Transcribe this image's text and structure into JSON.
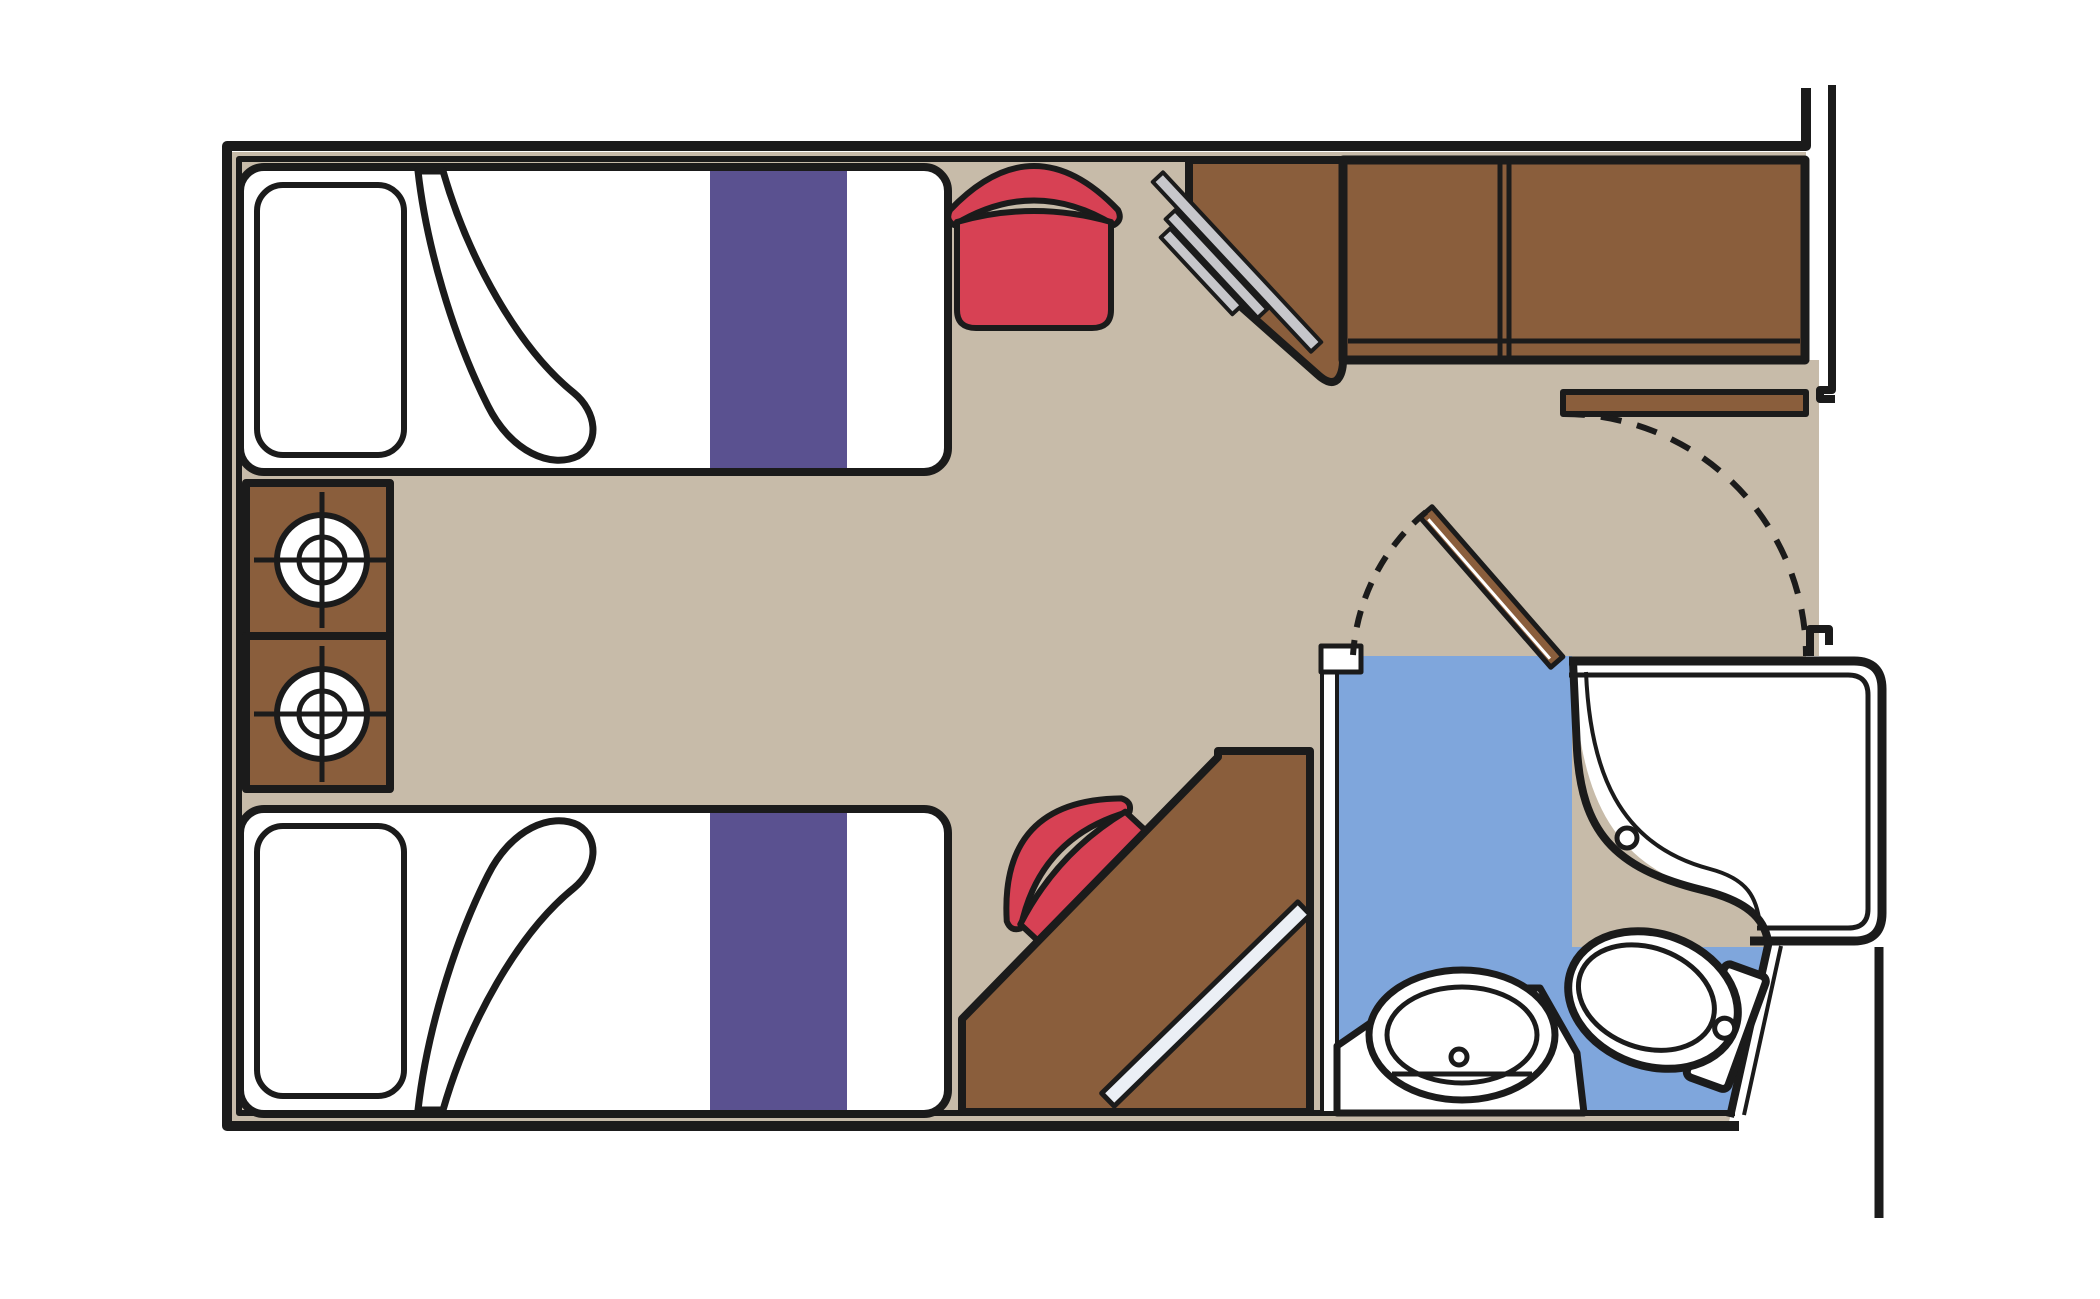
{
  "page": {
    "title": "Cruise cabin floor plan",
    "kind": "floor-plan"
  },
  "colors": {
    "ink": "#1B1B1B",
    "floor": "#C7BBA9",
    "wood": "#8A5E3C",
    "bathroom_floor": "#7FA6DC",
    "bed_runner": "#5A5190",
    "chair": "#D74154",
    "tv": "#C7C7CB",
    "mirror": "#EBEFF5",
    "fixture": "#FFFFFF"
  },
  "elements": {
    "beds": 2,
    "nightstands": 2,
    "lamps": 2,
    "chairs": 2,
    "desks": 2,
    "wardrobe_doors": 2,
    "bathroom_fixtures": [
      "shower",
      "sink",
      "toilet"
    ],
    "doors": [
      "entry-door",
      "bathroom-door"
    ],
    "door_swings": 2
  }
}
